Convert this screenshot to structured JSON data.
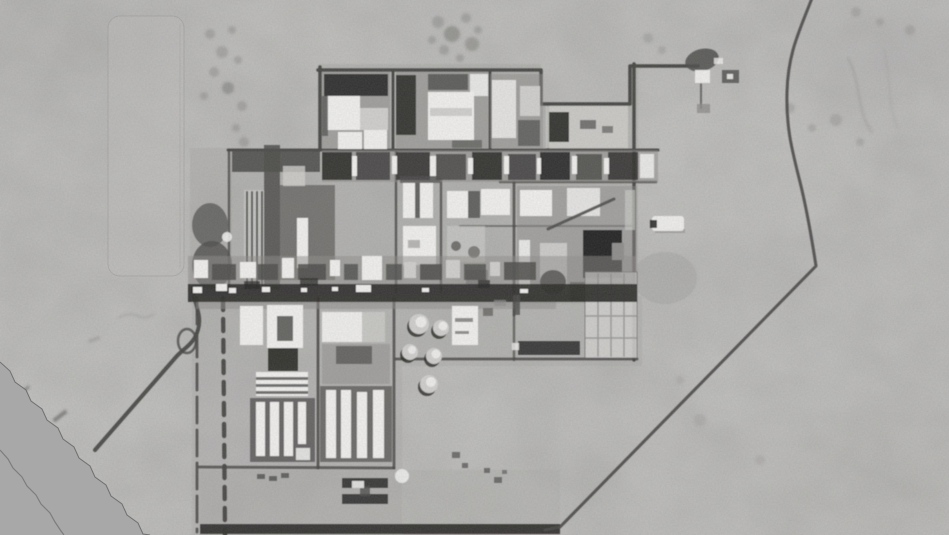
{
  "meta": {
    "type": "grayscale-aerial-photograph",
    "description": "Black-and-white overhead satellite photograph of a fenced industrial complex in flat desert terrain: a dense grid of roads and flat-roofed white and dark buildings, rows of narrow barracks-like structures, round storage tanks, a prominent dark east-west main road, a curving access road to the southwest, a perimeter road looping through the desert to the east, and a featureless flat gray photo-edge wedge covering the lower-left corner."
  },
  "palette": {
    "desert-base": "#b1b0ae",
    "desert-light": "#bdbcba",
    "desert-dark": "#a19f9d",
    "photo-edge": "#a8a8a8",
    "edge-line": "#606060",
    "road": "#454442",
    "road-dark": "#2e2d2b",
    "bldg-white": "#f0efed",
    "bldg-light": "#cfcecc",
    "mid-gray": "#8d8c8a",
    "struct-dark": "#4b4a48",
    "shadow-deep": "#242321",
    "ground-tint": "#a4a3a1"
  },
  "scene": {
    "features": [
      "desert terrain with mottled tonal patches",
      "faint graded strip upper-left",
      "industrial complex core with road grid",
      "main east-west dark road with light vehicle specks",
      "vertical striped utility rows",
      "round storage tanks",
      "barracks-style white building rows",
      "large dark southeast block with gridded annex",
      "curving southwest access road",
      "eastern perimeter road",
      "small outbuilding cluster northeast",
      "white vehicle object east of fence",
      "flat gray photo-edge wedge lower-left"
    ]
  }
}
